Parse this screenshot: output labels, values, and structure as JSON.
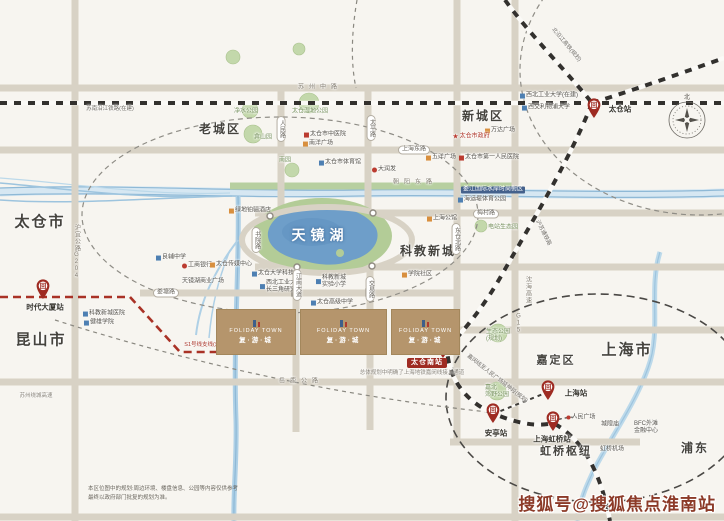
{
  "colors": {
    "background": "#f7f5f0",
    "road": "#d8d2c5",
    "railway": "#33312e",
    "metro_line_red": "#a93226",
    "water": "#9dc4de",
    "lake": "#6e9ec9",
    "green": "#b7cfa0",
    "building": "#b5956c",
    "station_pin": "#9e2b22",
    "watermark": "#8c3a28"
  },
  "lake": {
    "name": "天镜湖"
  },
  "watermark": {
    "text": "搜狐号@搜狐焦点淮南站"
  },
  "disclaimer": {
    "line1": "本区位图中的规划:周边环境、楼盘信息、公园等内容仅供参考",
    "line2": "最终以政府部门批复的规划为准。"
  },
  "compass": {
    "north_label": "北"
  },
  "building_logo": {
    "en": "FOLIDAY TOWN",
    "cn": "复·游·城"
  },
  "buildings": [
    {
      "x": 216,
      "y": 309,
      "w": 78,
      "h": 44
    },
    {
      "x": 300,
      "y": 309,
      "w": 85,
      "h": 44
    },
    {
      "x": 391,
      "y": 309,
      "w": 67,
      "h": 44
    }
  ],
  "area_labels": [
    {
      "name": "taicang-city",
      "text": "太仓市",
      "x": 40,
      "y": 222,
      "size": 15
    },
    {
      "name": "kunshan-city",
      "text": "昆山市",
      "x": 41,
      "y": 340,
      "size": 15
    },
    {
      "name": "old-town",
      "text": "老城区",
      "x": 220,
      "y": 130,
      "size": 12
    },
    {
      "name": "new-town",
      "text": "新城区",
      "x": 483,
      "y": 117,
      "size": 12
    },
    {
      "name": "sci-edu-city",
      "text": "科教新城",
      "x": 428,
      "y": 252,
      "size": 12
    },
    {
      "name": "jiading",
      "text": "嘉定区",
      "x": 556,
      "y": 361,
      "size": 11
    },
    {
      "name": "shanghai-city",
      "text": "上海市",
      "x": 627,
      "y": 350,
      "size": 15
    },
    {
      "name": "hongqiao-hub",
      "text": "虹桥枢纽",
      "x": 566,
      "y": 452,
      "size": 11
    },
    {
      "name": "pudong",
      "text": "浦东",
      "x": 695,
      "y": 449,
      "size": 12
    }
  ],
  "poi_labels": [
    {
      "name": "jingshui-park",
      "text": "净水公园",
      "x": 246,
      "y": 112,
      "color": "#77925f"
    },
    {
      "name": "wetland-park",
      "text": "太仓湿地公园",
      "x": 310,
      "y": 112,
      "color": "#77925f"
    },
    {
      "name": "yanshan-park",
      "text": "弇山园",
      "x": 263,
      "y": 138,
      "color": "#77925f"
    },
    {
      "name": "tcm-hospital",
      "text": "太仓市中医院",
      "x": 325,
      "y": 135,
      "icon": "hospital"
    },
    {
      "name": "nanyang-plaza",
      "text": "南洋广场",
      "x": 318,
      "y": 144,
      "icon": "mall"
    },
    {
      "name": "nan-park",
      "text": "南园",
      "x": 285,
      "y": 161,
      "color": "#77925f"
    },
    {
      "name": "sports-stadium",
      "text": "太仓市体育馆",
      "x": 340,
      "y": 163,
      "icon": "school"
    },
    {
      "name": "rt-mart",
      "text": "大润发",
      "x": 384,
      "y": 170,
      "icon": "bank"
    },
    {
      "name": "wuyang-plaza",
      "text": "五洋广场",
      "x": 441,
      "y": 158,
      "icon": "mall"
    },
    {
      "name": "wanda-plaza",
      "text": "万达广场",
      "x": 500,
      "y": 131,
      "icon": "mall"
    },
    {
      "name": "taicang-government",
      "text": "太仓市政府",
      "x": 471,
      "y": 137,
      "icon": "star",
      "color": "#b03a2e"
    },
    {
      "name": "first-peoples-hospital",
      "text": "太仓市第一人民医院",
      "x": 489,
      "y": 158,
      "icon": "hospital"
    },
    {
      "name": "nwpu",
      "text": "西北工业大学(在建)",
      "x": 549,
      "y": 96,
      "icon": "school"
    },
    {
      "name": "xjtlu",
      "text": "西交利物浦大学",
      "x": 546,
      "y": 108,
      "icon": "school"
    },
    {
      "name": "greenland-hotel",
      "text": "绿地铂骊酒店",
      "x": 250,
      "y": 211,
      "icon": "mall"
    },
    {
      "name": "liangfu-middle-school",
      "text": "良辅中学",
      "x": 171,
      "y": 258,
      "icon": "school"
    },
    {
      "name": "icbc-bank",
      "text": "工商银行",
      "x": 197,
      "y": 266,
      "icon": "bank"
    },
    {
      "name": "media-center",
      "text": "太仓传媒中心",
      "x": 231,
      "y": 265,
      "icon": "mall"
    },
    {
      "name": "tianjinghu-plaza",
      "text": "天镜湖商业广场",
      "x": 203,
      "y": 282
    },
    {
      "name": "univ-science-park",
      "text": "太仓大学科技园",
      "x": 276,
      "y": 274,
      "icon": "school"
    },
    {
      "name": "nwpu-yangtze-institute",
      "lines": [
        "西北工业大学",
        "长三角研究院"
      ],
      "x": 281,
      "y": 287,
      "icon": "school"
    },
    {
      "name": "experimental-primary",
      "lines": [
        "科教新城",
        "实验小学"
      ],
      "x": 331,
      "y": 282,
      "icon": "school"
    },
    {
      "name": "taicang-senior-high",
      "text": "太仓高级中学",
      "x": 332,
      "y": 303,
      "icon": "school"
    },
    {
      "name": "kjxc-hospital",
      "text": "科教新城医院",
      "x": 104,
      "y": 314,
      "icon": "school"
    },
    {
      "name": "jianxiong-college",
      "text": "健雄学院",
      "x": 99,
      "y": 323,
      "icon": "school"
    },
    {
      "name": "xueyuan-community",
      "text": "学院社区",
      "x": 417,
      "y": 275,
      "icon": "mall"
    },
    {
      "name": "shanghai-mansion",
      "text": "上海公馆",
      "x": 442,
      "y": 219,
      "icon": "mall"
    },
    {
      "name": "haiyundi-park",
      "text": "海运堤体育公园",
      "x": 482,
      "y": 200,
      "icon": "school"
    },
    {
      "name": "loujiang-waterfront",
      "text": "娄江国际水岸时尚街区",
      "x": 493,
      "y": 190,
      "boxed": true
    },
    {
      "name": "dianzhan-eco-park",
      "text": "电站生态园",
      "x": 503,
      "y": 228,
      "color": "#77925f"
    },
    {
      "name": "eco-park-planned",
      "lines": [
        "生态公园",
        "(规划)"
      ],
      "x": 498,
      "y": 336,
      "color": "#77925f"
    },
    {
      "name": "jiabei-country-park",
      "lines": [
        "嘉北",
        "郊野公园"
      ],
      "x": 497,
      "y": 392,
      "color": "#77925f"
    },
    {
      "name": "peoples-square",
      "text": "人民广场",
      "x": 581,
      "y": 418,
      "icon": "dot"
    },
    {
      "name": "chenghuang-temple",
      "text": "城隍庙",
      "x": 610,
      "y": 425
    },
    {
      "name": "bfc-bund-finance-center",
      "lines": [
        "BFC外滩",
        "金融中心"
      ],
      "x": 646,
      "y": 428
    },
    {
      "name": "hongqiao-airport",
      "text": "虹桥机场",
      "x": 612,
      "y": 450
    }
  ],
  "road_labels": [
    {
      "name": "suzhou-middle-rd",
      "text": "苏州中路",
      "x": 320,
      "y": 88,
      "v": "spaced"
    },
    {
      "name": "renmin-rd",
      "text": "人民路",
      "x": 281,
      "y": 129,
      "v": "ovalv"
    },
    {
      "name": "taiping-rd",
      "text": "太平路",
      "x": 371,
      "y": 128,
      "v": "ovalv"
    },
    {
      "name": "shanghai-east-rd",
      "text": "上海东路",
      "x": 414,
      "y": 150,
      "v": "oval"
    },
    {
      "name": "shuyuan-rd",
      "text": "书院路",
      "x": 256,
      "y": 240,
      "v": "ovalv"
    },
    {
      "name": "jiangnan-ave",
      "text": "江南大道",
      "x": 297,
      "y": 285,
      "v": "ovalv"
    },
    {
      "name": "jiaoyi-rd",
      "text": "交易路",
      "x": 370,
      "y": 289,
      "v": "ovalv"
    },
    {
      "name": "dongcang-north-rd",
      "text": "东仓北路",
      "x": 456,
      "y": 239,
      "v": "ovalv"
    },
    {
      "name": "meicun-rd",
      "text": "梅村路",
      "x": 486,
      "y": 214,
      "v": "oval"
    },
    {
      "name": "loutang-rd",
      "text": "娄塘路",
      "x": 166,
      "y": 293,
      "v": "oval"
    },
    {
      "name": "chaoyang-east-rd",
      "text": "朝阳东路",
      "x": 415,
      "y": 183,
      "v": "spaced"
    },
    {
      "name": "yuelu-highway",
      "text": "岳鹿公路",
      "x": 301,
      "y": 382,
      "v": "spaced"
    },
    {
      "name": "huyi-highway",
      "text": "沪宜公路G204",
      "x": 76,
      "y": 252,
      "v": "vplain"
    },
    {
      "name": "shenhai-expwy",
      "text": "沈海高速",
      "x": 527,
      "y": 290,
      "v": "vplain"
    },
    {
      "name": "g15",
      "text": "G15",
      "x": 518,
      "y": 324,
      "v": "vplain"
    },
    {
      "name": "suzhou-ring-expwy",
      "text": "苏州绕城高速",
      "x": 36,
      "y": 396,
      "v": "tiny"
    }
  ],
  "rail_labels": [
    {
      "name": "sunan-yanjiang-railway",
      "text": "苏南沿江铁路(在建)",
      "x": 110,
      "y": 109,
      "rotate": 0
    },
    {
      "name": "beiyanjiang-hsr",
      "text": "北沿江高铁(规划)",
      "x": 566,
      "y": 45,
      "rotate": 50
    },
    {
      "name": "husutong-railway",
      "text": "沪苏通铁路",
      "x": 543,
      "y": 233,
      "rotate": 63
    },
    {
      "name": "s1-branch-line",
      "text": "S1号线支线(规划)",
      "x": 206,
      "y": 345,
      "rotate": 0,
      "color": "#a93226"
    },
    {
      "name": "jiamin-extension",
      "text": "嘉闵线至人民广场延伸段(规划)",
      "x": 497,
      "y": 379,
      "rotate": 38
    },
    {
      "name": "planning-note",
      "text": "总体规划中明确了上海地铁嘉闵线接入通道",
      "x": 412,
      "y": 373,
      "rotate": 0,
      "color": "#8a857c"
    }
  ],
  "stations": [
    {
      "name": "taicang-station",
      "label": "太仓站",
      "x": 594,
      "y": 118,
      "lx": 620,
      "ly": 110
    },
    {
      "name": "shidai-dasha-station",
      "label": "时代大厦站",
      "x": 43,
      "y": 299,
      "lx": 45,
      "ly": 308
    },
    {
      "name": "taicang-south-station",
      "label": "太仓南站",
      "x": 443,
      "y": 358,
      "lx": 427,
      "ly": 363,
      "boxed": true
    },
    {
      "name": "shanghai-station",
      "label": "上海站",
      "x": 548,
      "y": 400,
      "lx": 576,
      "ly": 394
    },
    {
      "name": "anting-station",
      "label": "安亭站",
      "x": 493,
      "y": 423,
      "lx": 496,
      "ly": 434
    },
    {
      "name": "hongqiao-station",
      "label": "上海虹桥站",
      "x": 553,
      "y": 431,
      "lx": 552,
      "ly": 440
    }
  ]
}
